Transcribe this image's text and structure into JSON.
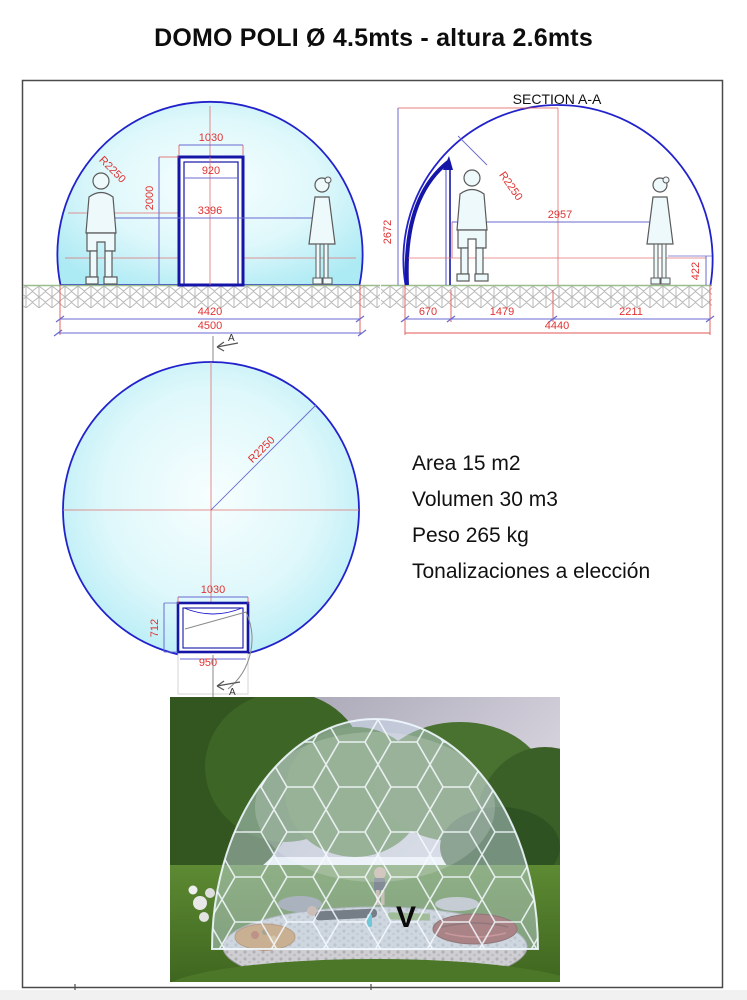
{
  "title": "DOMO POLI Ø 4.5mts - altura 2.6mts",
  "front": {
    "door_frame_width": "1030",
    "door_opening_width": "920",
    "door_height": "2000",
    "interior_span": "3396",
    "radius": "R2250",
    "base_width": "4420",
    "overall_width": "4500"
  },
  "section": {
    "title": "SECTION A-A",
    "overall_height": "2672",
    "radius": "R2250",
    "interior_span": "2957",
    "base_offset": "422",
    "door_offset": "670",
    "span_left": "1479",
    "span_right": "2211",
    "base_width": "4440"
  },
  "plan": {
    "radius": "R2250",
    "door_frame_width": "1030",
    "door_depth": "712",
    "door_width": "950",
    "section_marker": "A"
  },
  "specs": {
    "area": "Area 15 m2",
    "volume": "Volumen 30 m3",
    "weight": "Peso 265 kg",
    "finish": "Tonalizaciones a elección"
  },
  "photo": {
    "caption": "V"
  },
  "colors": {
    "outline_blue": "#2222cc",
    "door_navy": "#1515a8",
    "dimension_red": "#e03333",
    "dimension_blue": "#6a6ad0",
    "fill_cyan": "#aeeaf4",
    "ground_green": "#9bbd8e"
  }
}
